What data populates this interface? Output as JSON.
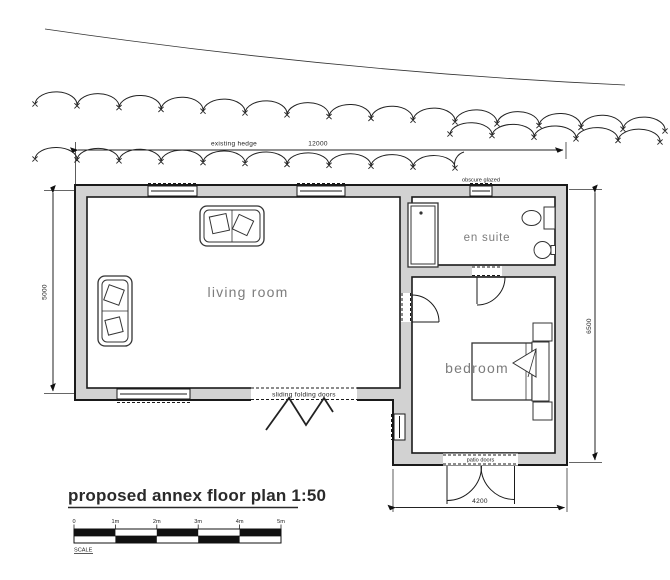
{
  "title": "proposed annex floor plan 1:50",
  "rooms": {
    "living": "living room",
    "bedroom": "bedroom",
    "ensuite": "en suite"
  },
  "annotations": {
    "hedge_label": "existing hedge",
    "hedge_dim": "12000",
    "obscure_glazed": "obscure glazed",
    "sliding_doors": "sliding folding doors",
    "patio_doors": "patio doors",
    "dim_left": "5000",
    "dim_right": "6500",
    "dim_bottom": "4200"
  },
  "scale_bar": {
    "labels": [
      "0",
      "1m",
      "2m",
      "3m",
      "4m",
      "5m"
    ],
    "caption": "SCALE"
  },
  "colors": {
    "wall_fill": "#d2d2d2",
    "line": "#1a1a1a",
    "room_label": "#7c7c7c"
  }
}
